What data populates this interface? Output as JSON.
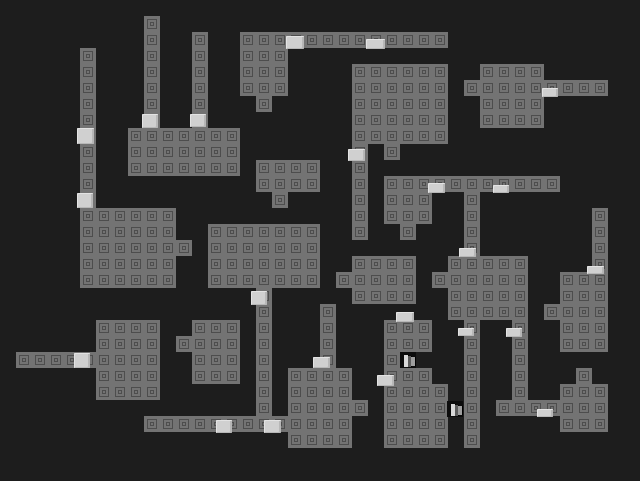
{
  "app": {
    "name": "dungeon-tile-map",
    "view": "level-overview"
  },
  "map": {
    "tile_size": 16,
    "grid_cols": 40,
    "grid_rows": 30,
    "colors": {
      "background": "#1d1d1d",
      "wall_face": "#737373",
      "wall_glyph": "#4d4d4d",
      "door_face": "#d0d0d0",
      "door_highlight": "#e3e3e3",
      "door_shadow": "#b7b7b7",
      "special_bg": "#0c0c0c",
      "special_bars": [
        "#d9d9d9",
        "#5c5c5c",
        "#9e9e9e"
      ]
    },
    "special_bar_layout": [
      {
        "dx": 4,
        "dy": 3,
        "w": 4,
        "h": 12
      },
      {
        "dx": 8,
        "dy": 4,
        "w": 3,
        "h": 11
      },
      {
        "dx": 11,
        "dy": 5,
        "w": 4,
        "h": 9
      }
    ],
    "walls": [
      {
        "c": 9,
        "r": 1,
        "w": 1,
        "h": 7
      },
      {
        "c": 12,
        "r": 2,
        "w": 1,
        "h": 6
      },
      {
        "c": 5,
        "r": 3,
        "w": 1,
        "h": 10
      },
      {
        "c": 15,
        "r": 2,
        "w": 13,
        "h": 1
      },
      {
        "c": 15,
        "r": 3,
        "w": 3,
        "h": 3
      },
      {
        "c": 16,
        "r": 6,
        "w": 1,
        "h": 1
      },
      {
        "c": 22,
        "r": 4,
        "w": 6,
        "h": 5
      },
      {
        "c": 22,
        "r": 9,
        "w": 1,
        "h": 6
      },
      {
        "c": 24,
        "r": 9,
        "w": 1,
        "h": 1
      },
      {
        "c": 29,
        "r": 5,
        "w": 1,
        "h": 1
      },
      {
        "c": 30,
        "r": 4,
        "w": 4,
        "h": 4
      },
      {
        "c": 34,
        "r": 5,
        "w": 4,
        "h": 1
      },
      {
        "c": 8,
        "r": 8,
        "w": 7,
        "h": 3
      },
      {
        "c": 16,
        "r": 10,
        "w": 4,
        "h": 2
      },
      {
        "c": 17,
        "r": 12,
        "w": 1,
        "h": 1
      },
      {
        "c": 24,
        "r": 11,
        "w": 11,
        "h": 1
      },
      {
        "c": 24,
        "r": 12,
        "w": 3,
        "h": 2
      },
      {
        "c": 25,
        "r": 14,
        "w": 1,
        "h": 1
      },
      {
        "c": 29,
        "r": 12,
        "w": 1,
        "h": 4
      },
      {
        "c": 37,
        "r": 13,
        "w": 1,
        "h": 4
      },
      {
        "c": 5,
        "r": 13,
        "w": 6,
        "h": 5
      },
      {
        "c": 11,
        "r": 15,
        "w": 1,
        "h": 1
      },
      {
        "c": 13,
        "r": 14,
        "w": 7,
        "h": 4
      },
      {
        "c": 22,
        "r": 16,
        "w": 4,
        "h": 3
      },
      {
        "c": 21,
        "r": 17,
        "w": 1,
        "h": 1
      },
      {
        "c": 28,
        "r": 16,
        "w": 5,
        "h": 4
      },
      {
        "c": 27,
        "r": 17,
        "w": 1,
        "h": 1
      },
      {
        "c": 35,
        "r": 17,
        "w": 3,
        "h": 5
      },
      {
        "c": 34,
        "r": 19,
        "w": 1,
        "h": 1
      },
      {
        "c": 16,
        "r": 18,
        "w": 1,
        "h": 8
      },
      {
        "c": 20,
        "r": 19,
        "w": 1,
        "h": 4
      },
      {
        "c": 6,
        "r": 20,
        "w": 4,
        "h": 5
      },
      {
        "c": 1,
        "r": 22,
        "w": 5,
        "h": 1
      },
      {
        "c": 12,
        "r": 20,
        "w": 3,
        "h": 4
      },
      {
        "c": 11,
        "r": 21,
        "w": 1,
        "h": 1
      },
      {
        "c": 24,
        "r": 20,
        "w": 3,
        "h": 2
      },
      {
        "c": 24,
        "r": 22,
        "w": 1,
        "h": 1
      },
      {
        "c": 24,
        "r": 23,
        "w": 3,
        "h": 1
      },
      {
        "c": 24,
        "r": 24,
        "w": 4,
        "h": 4
      },
      {
        "c": 29,
        "r": 20,
        "w": 1,
        "h": 8
      },
      {
        "c": 32,
        "r": 20,
        "w": 1,
        "h": 5
      },
      {
        "c": 31,
        "r": 25,
        "w": 4,
        "h": 1
      },
      {
        "c": 18,
        "r": 23,
        "w": 4,
        "h": 5
      },
      {
        "c": 22,
        "r": 25,
        "w": 1,
        "h": 1
      },
      {
        "c": 9,
        "r": 26,
        "w": 9,
        "h": 1
      },
      {
        "c": 35,
        "r": 24,
        "w": 3,
        "h": 3
      },
      {
        "c": 36,
        "r": 23,
        "w": 1,
        "h": 1
      }
    ],
    "doors": [
      {
        "x": 286,
        "y": 36,
        "w": 18,
        "h": 13
      },
      {
        "x": 366,
        "y": 39,
        "w": 19,
        "h": 10
      },
      {
        "x": 542,
        "y": 88,
        "w": 16,
        "h": 9
      },
      {
        "x": 142,
        "y": 114,
        "w": 16,
        "h": 14
      },
      {
        "x": 190,
        "y": 114,
        "w": 16,
        "h": 13
      },
      {
        "x": 77,
        "y": 128,
        "w": 17,
        "h": 16
      },
      {
        "x": 348,
        "y": 149,
        "w": 17,
        "h": 12
      },
      {
        "x": 428,
        "y": 183,
        "w": 17,
        "h": 10
      },
      {
        "x": 493,
        "y": 185,
        "w": 16,
        "h": 8
      },
      {
        "x": 77,
        "y": 193,
        "w": 16,
        "h": 15
      },
      {
        "x": 459,
        "y": 248,
        "w": 17,
        "h": 9
      },
      {
        "x": 587,
        "y": 266,
        "w": 17,
        "h": 8
      },
      {
        "x": 251,
        "y": 291,
        "w": 16,
        "h": 14
      },
      {
        "x": 396,
        "y": 312,
        "w": 18,
        "h": 10
      },
      {
        "x": 458,
        "y": 328,
        "w": 16,
        "h": 8
      },
      {
        "x": 506,
        "y": 328,
        "w": 16,
        "h": 9
      },
      {
        "x": 74,
        "y": 353,
        "w": 16,
        "h": 15
      },
      {
        "x": 313,
        "y": 357,
        "w": 17,
        "h": 11
      },
      {
        "x": 377,
        "y": 375,
        "w": 17,
        "h": 11
      },
      {
        "x": 537,
        "y": 409,
        "w": 16,
        "h": 8
      },
      {
        "x": 216,
        "y": 420,
        "w": 16,
        "h": 13
      },
      {
        "x": 264,
        "y": 420,
        "w": 17,
        "h": 13
      }
    ],
    "specials": [
      {
        "x": 400,
        "y": 352
      },
      {
        "x": 447,
        "y": 401
      }
    ]
  }
}
